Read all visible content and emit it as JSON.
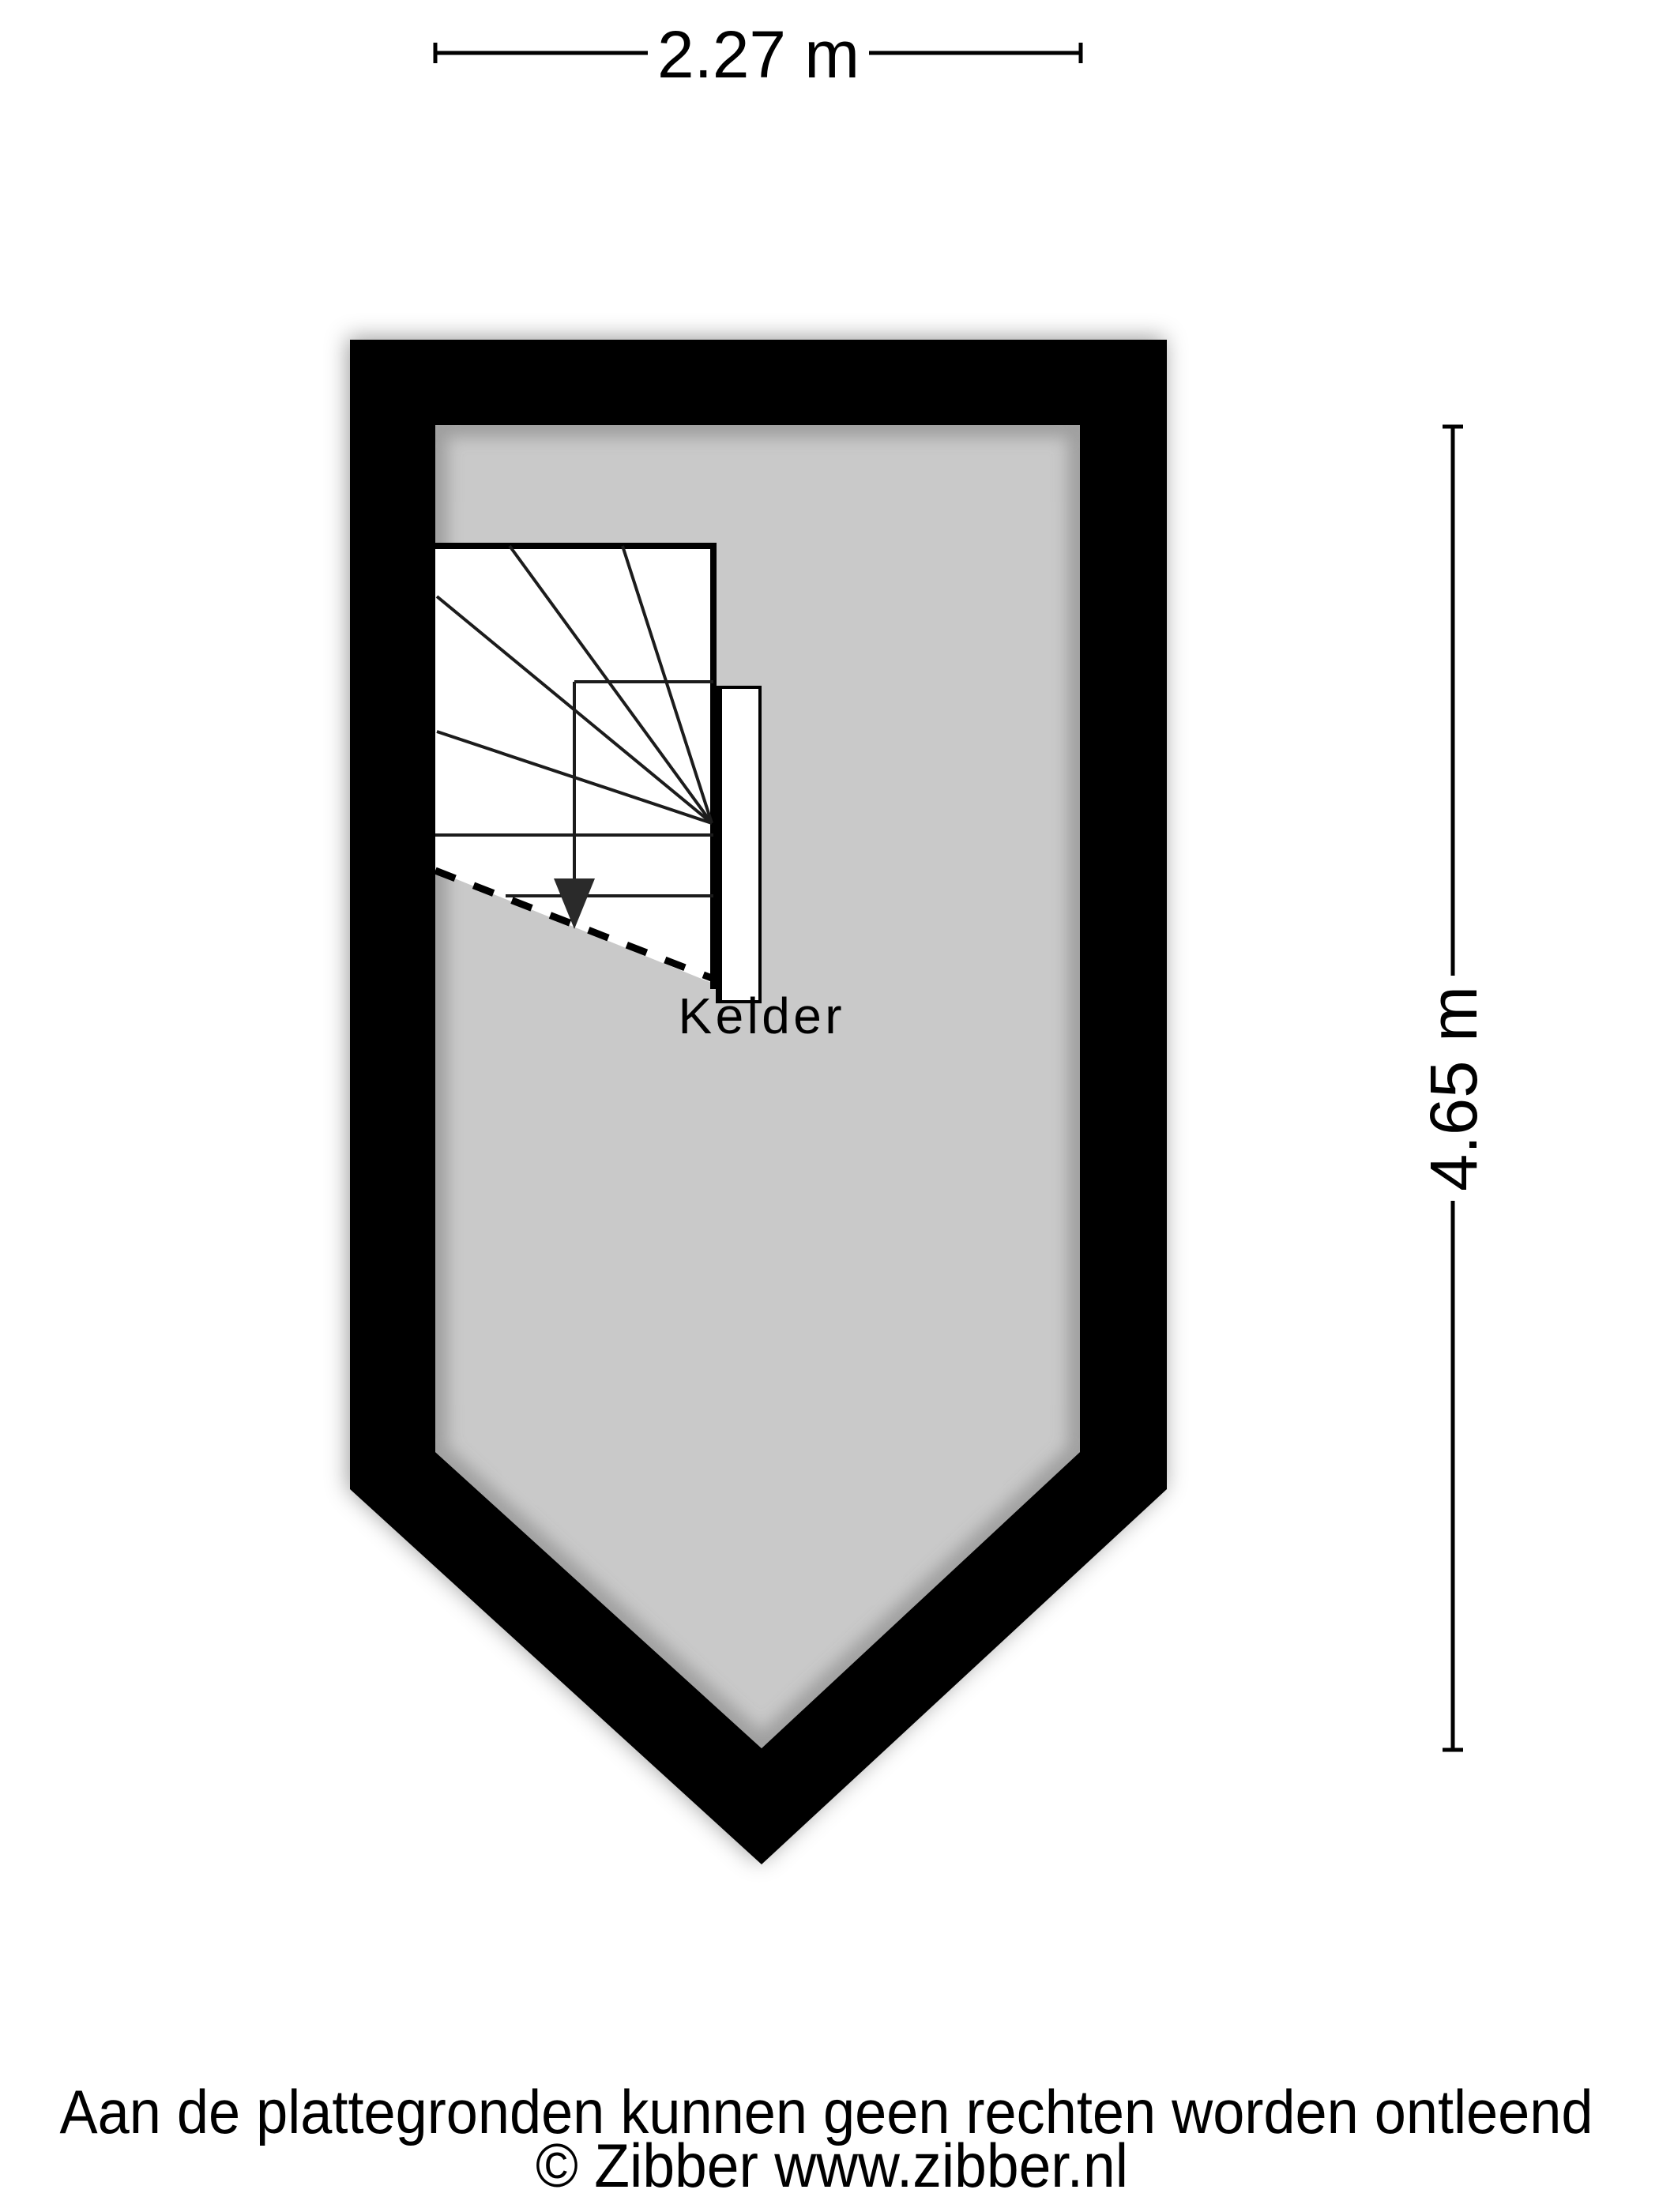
{
  "dimensions": {
    "width_label": "2.27 m",
    "height_label": "4.65 m"
  },
  "room": {
    "label": "Kelder"
  },
  "footer": {
    "disclaimer": "Aan de plattegronden kunnen geen rechten worden ontleend",
    "copyright": "© Zibber www.zibber.nl"
  },
  "colors": {
    "wall": "#000000",
    "floor": "#c9c9c9",
    "stair": "#ffffff",
    "background": "#ffffff"
  }
}
